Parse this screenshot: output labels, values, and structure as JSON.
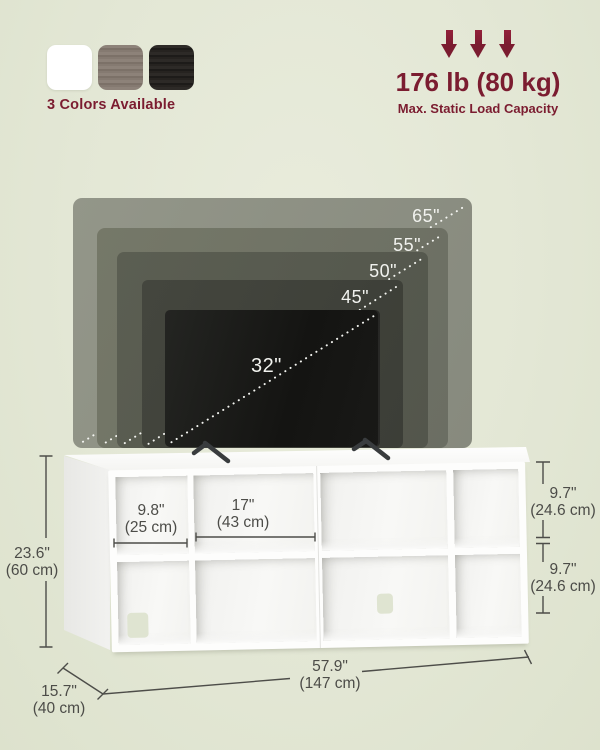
{
  "header": {
    "colors": {
      "label": "3 Colors Available",
      "swatches": [
        {
          "name": "white",
          "hex": "#ffffff"
        },
        {
          "name": "gray-wood",
          "hex": "#857a71"
        },
        {
          "name": "black-wood",
          "hex": "#252220"
        }
      ]
    },
    "load": {
      "value": "176 lb (80 kg)",
      "caption": "Max. Static Load Capacity"
    }
  },
  "tv_compatibility": {
    "sizes": [
      "65\"",
      "55\"",
      "50\"",
      "45\"",
      "32\""
    ]
  },
  "dimensions": {
    "height": {
      "in": "23.6\"",
      "cm": "(60 cm)"
    },
    "small_cubby_width": {
      "in": "9.8\"",
      "cm": "(25 cm)"
    },
    "large_cubby_width": {
      "in": "17\"",
      "cm": "(43 cm)"
    },
    "top_cubby_height": {
      "in": "9.7\"",
      "cm": "(24.6 cm)"
    },
    "bottom_cubby_height": {
      "in": "9.7\"",
      "cm": "(24.6 cm)"
    },
    "total_width": {
      "in": "57.9\"",
      "cm": "(147 cm)"
    },
    "depth": {
      "in": "15.7\"",
      "cm": "(40 cm)"
    }
  },
  "palette": {
    "accent_maroon": "#7b1c30",
    "background_sage": "#e3e7d5",
    "dimension_text": "#4c4c48"
  }
}
